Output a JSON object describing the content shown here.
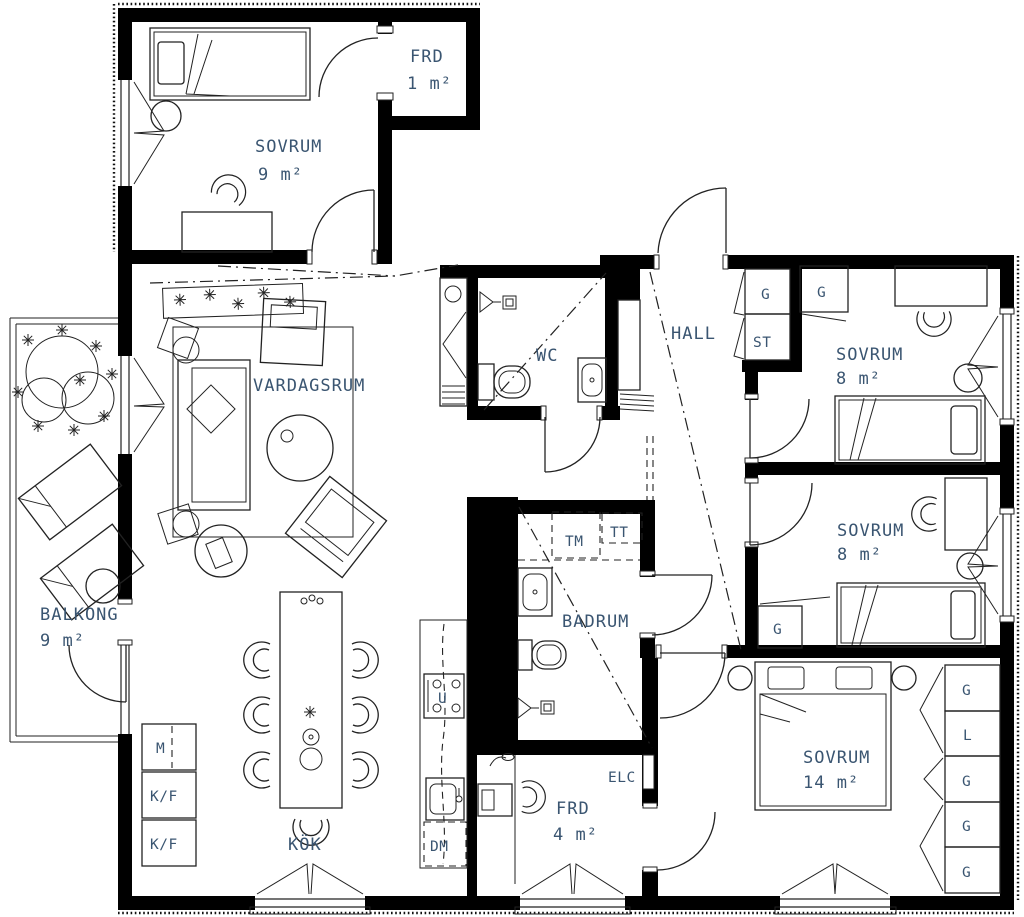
{
  "meta": {
    "type": "apartment-floor-plan"
  },
  "colors": {
    "wall": "#000000",
    "line": "#222222",
    "label": "#3a5571",
    "background": "#ffffff"
  },
  "rooms": {
    "sovrum_9": {
      "name": "SOVRUM",
      "area": "9 m²"
    },
    "frd_1": {
      "name": "FRD",
      "area": "1 m²"
    },
    "vardagsrum": {
      "name": "VARDAGSRUM"
    },
    "wc": {
      "name": "WC"
    },
    "hall": {
      "name": "HALL"
    },
    "sovrum_8_top": {
      "name": "SOVRUM",
      "area": "8 m²"
    },
    "sovrum_8_mid": {
      "name": "SOVRUM",
      "area": "8 m²"
    },
    "badrum": {
      "name": "BADRUM"
    },
    "balkong": {
      "name": "BALKONG",
      "area": "9 m²"
    },
    "kok": {
      "name": "KÖK"
    },
    "frd_4": {
      "name": "FRD",
      "area": "4 m²"
    },
    "sovrum_14": {
      "name": "SOVRUM",
      "area": "14 m²"
    }
  },
  "closets": {
    "hall_g": "G",
    "hall_st": "ST",
    "top_bedroom_g": "G",
    "mid_bedroom_g": "G",
    "master": [
      "G",
      "L",
      "G",
      "G",
      "G"
    ]
  },
  "appliances": {
    "tm": "TM",
    "tt": "TT",
    "microwave": "M",
    "fridge1": "K/F",
    "fridge2": "K/F",
    "oven": "U",
    "dishwasher": "DM",
    "elc": "ELC"
  }
}
